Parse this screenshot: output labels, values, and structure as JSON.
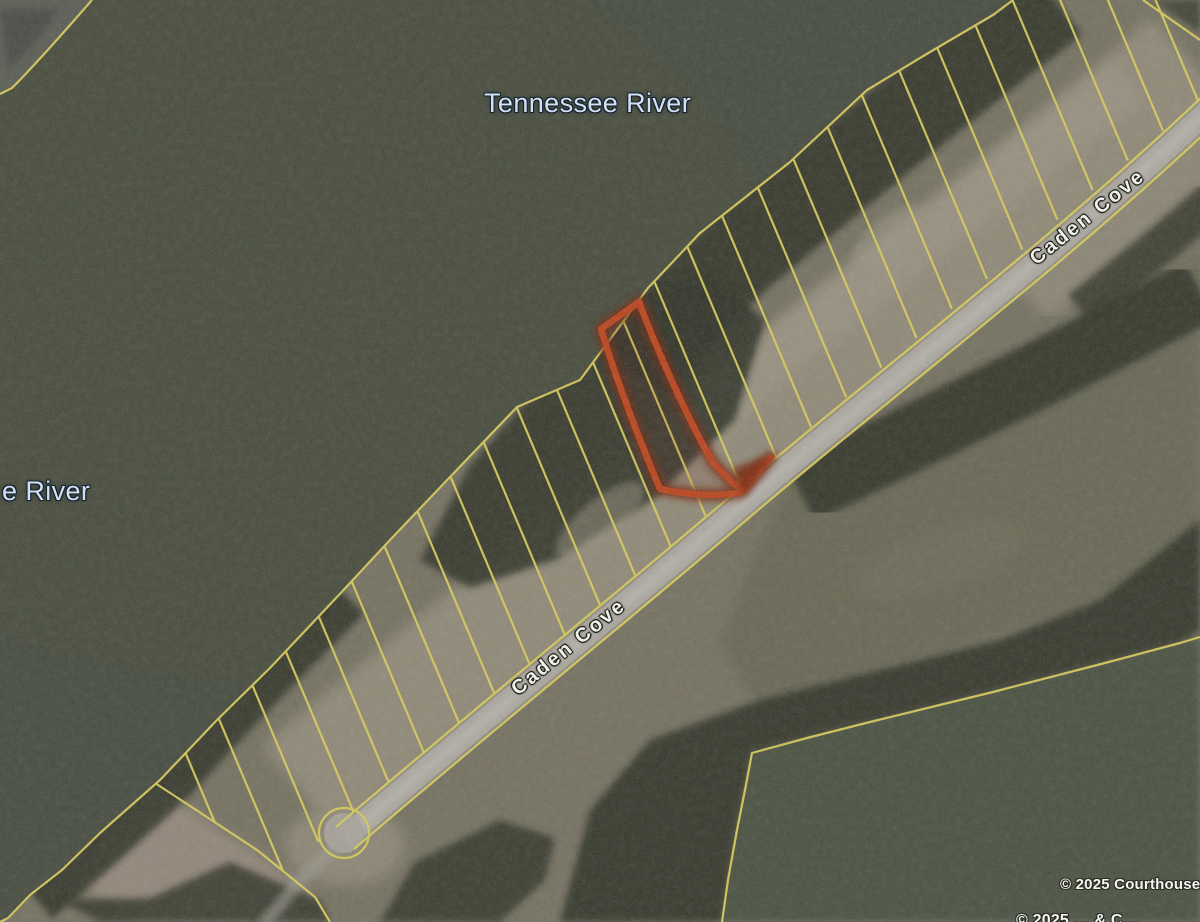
{
  "map": {
    "water_label_main": "Tennessee River",
    "water_label_partial": "e River",
    "road_name": "Caden Cove",
    "attribution": "© 2025 Courthouse",
    "attribution_cutoff": "© 2025 … & C…",
    "highlighted_parcel": "red-outlined lot on Caden Cove",
    "colors": {
      "water": "#3c4134",
      "land": "#6e6a58",
      "trees": "#262a1d",
      "field_tan": "#8d8672",
      "field_light": "#958e7c",
      "field_olive": "#5f5e4a",
      "field_green": "#3e4734",
      "road": "#a7a399",
      "road_edge": "#8f8b80",
      "parcel_line": "#d9cb52",
      "highlight_stroke": "#b83a10",
      "highlight_dark": "#6f1c04",
      "water_label": "#cfe2f4",
      "road_label": "#f0f1ed"
    }
  }
}
